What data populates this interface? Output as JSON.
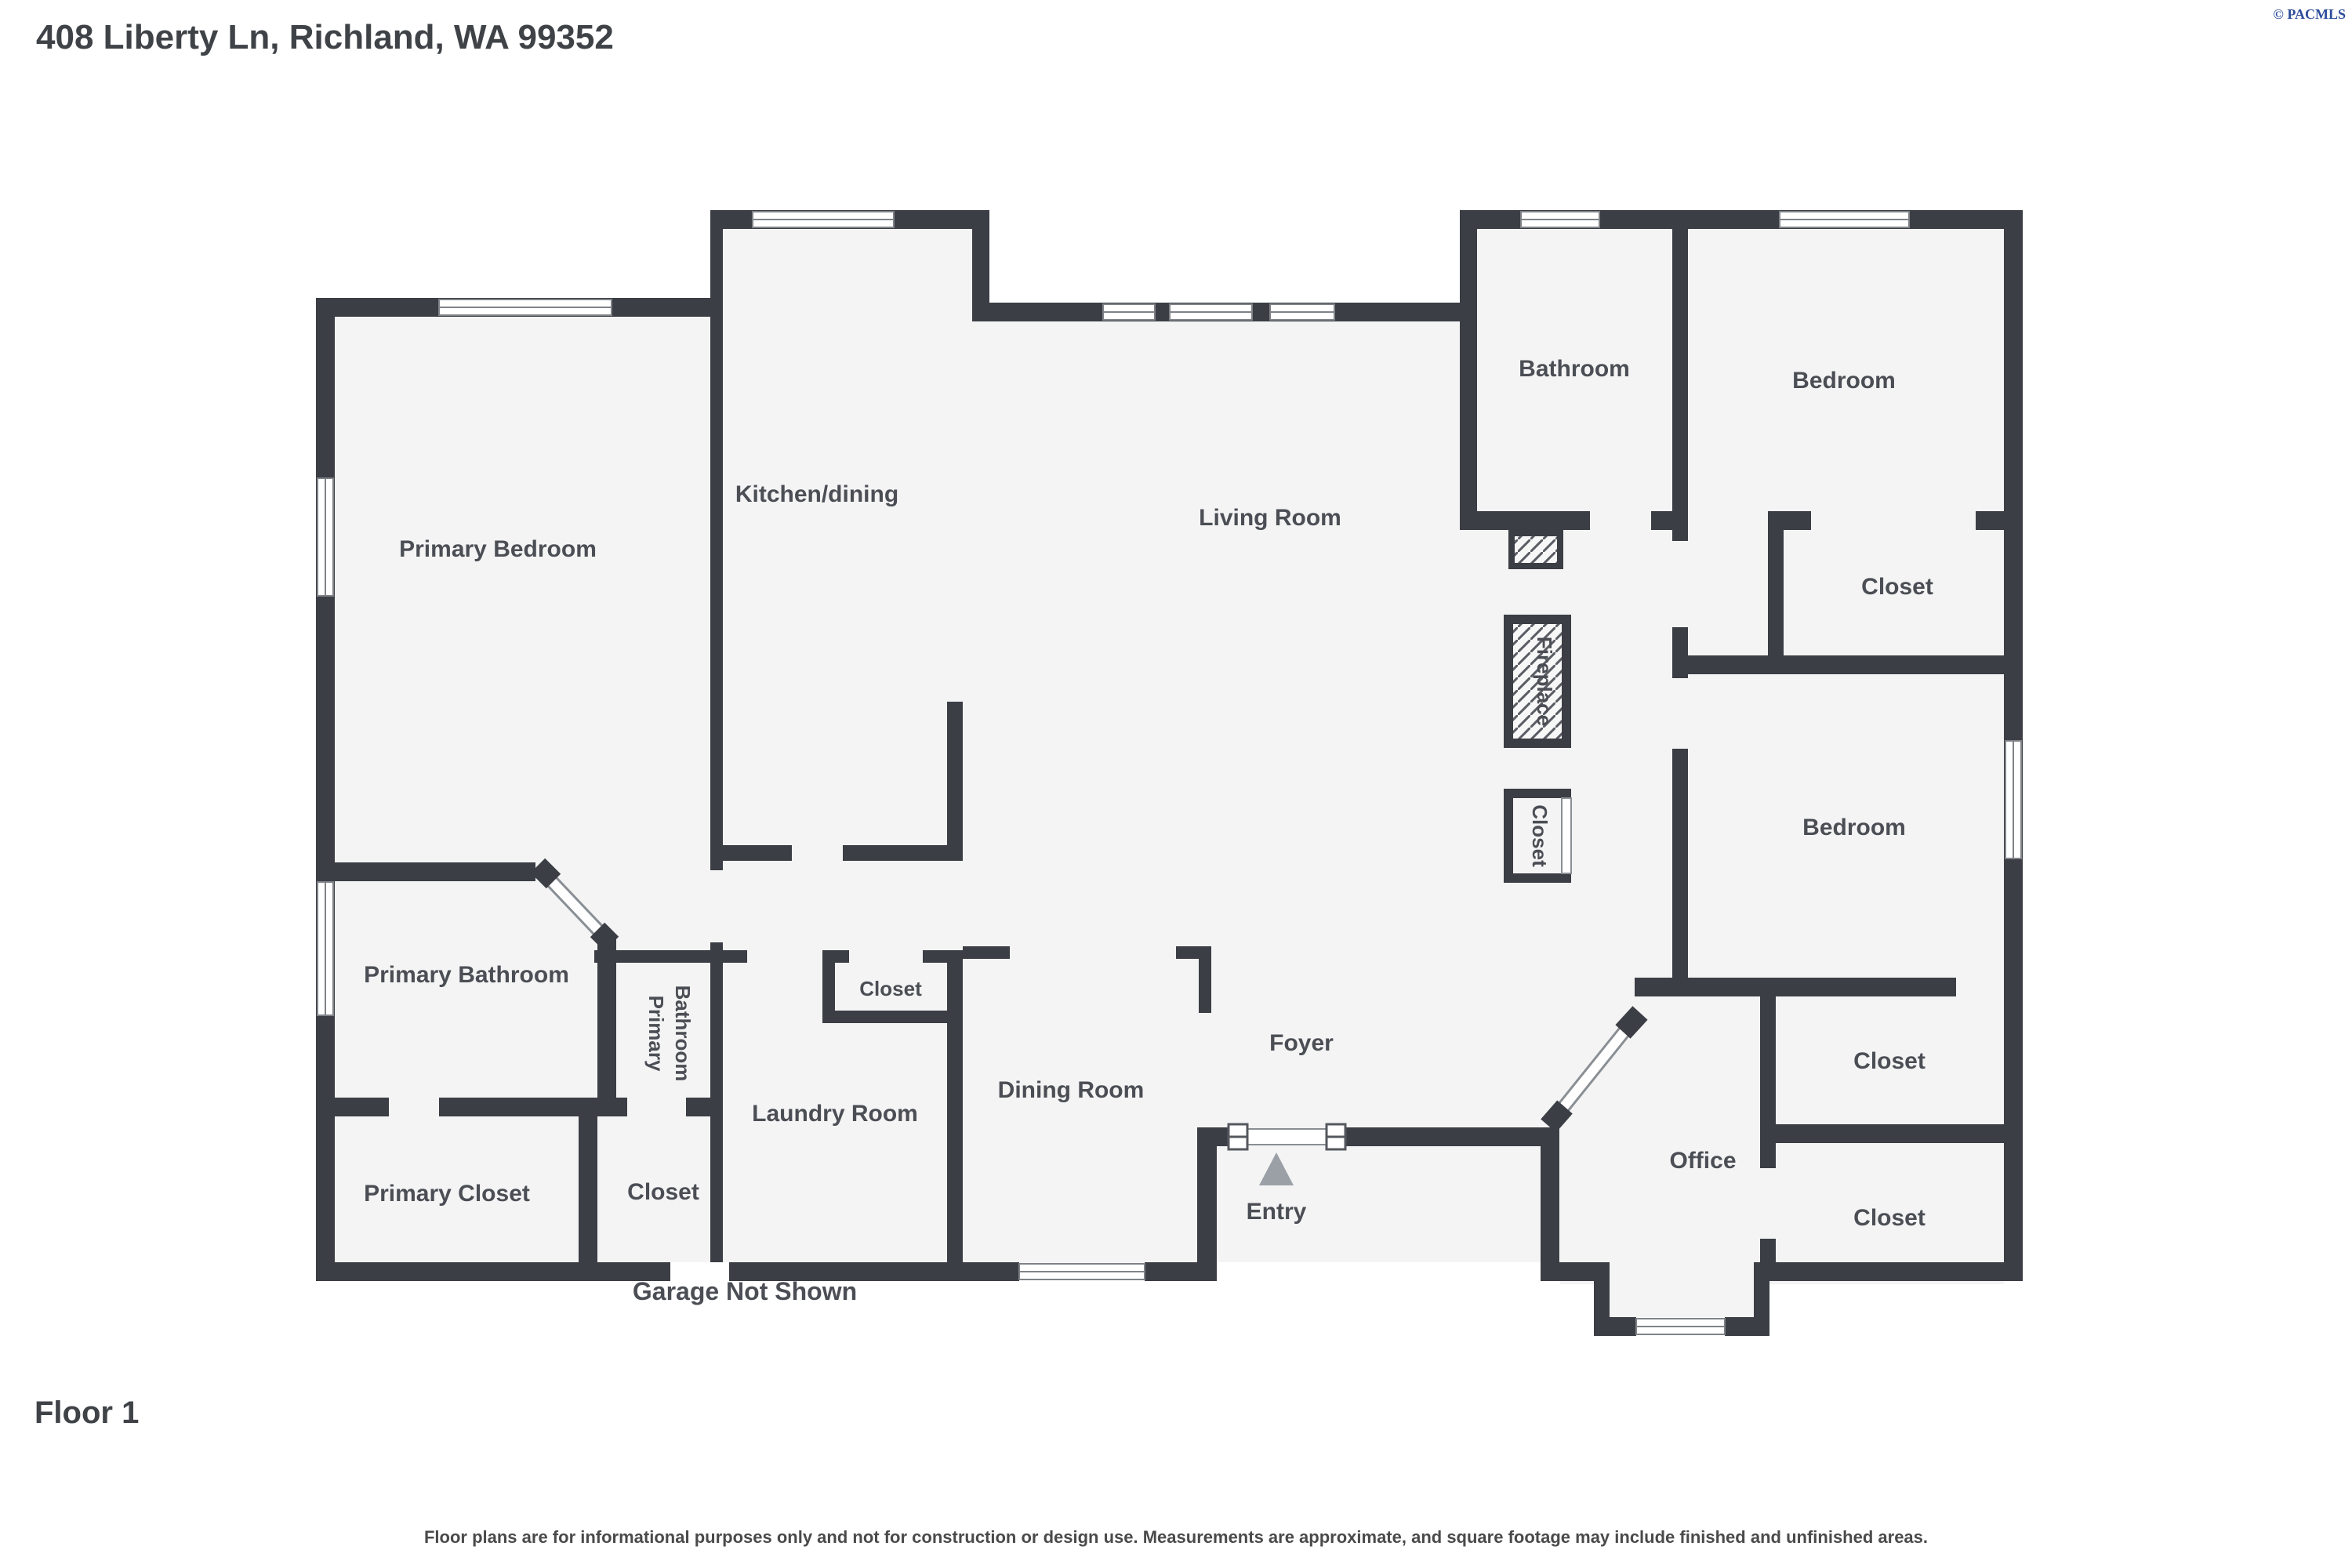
{
  "header": {
    "title": "408 Liberty Ln, Richland, WA 99352",
    "copyright": "© PACMLS"
  },
  "floor": {
    "label": "Floor 1"
  },
  "annotations": {
    "garage_note": "Garage Not Shown",
    "entry_arrow_icon": "triangle-up",
    "disclaimer": "Floor plans are for informational purposes only and not for construction or design use. Measurements are approximate, and square footage may include finished and unfinished areas."
  },
  "colors": {
    "wall": "#3b3e44",
    "room_fill": "#f4f4f5",
    "label": "#4b4e54",
    "copyright_blue": "#2e4d9c",
    "entry_arrow": "#9aa0a6",
    "background": "#ffffff"
  },
  "rooms": [
    {
      "id": "primary-bedroom",
      "label": "Primary Bedroom"
    },
    {
      "id": "kitchen-dining",
      "label": "Kitchen/dining"
    },
    {
      "id": "living-room",
      "label": "Living Room"
    },
    {
      "id": "bathroom",
      "label": "Bathroom"
    },
    {
      "id": "bedroom-ne",
      "label": "Bedroom"
    },
    {
      "id": "closet-ne",
      "label": "Closet"
    },
    {
      "id": "bedroom-e",
      "label": "Bedroom"
    },
    {
      "id": "primary-bathroom",
      "label": "Primary Bathroom"
    },
    {
      "id": "primary-closet",
      "label": "Primary Closet"
    },
    {
      "id": "closet-center",
      "label": "Closet"
    },
    {
      "id": "laundry-room",
      "label": "Laundry Room"
    },
    {
      "id": "closet-kitchen",
      "label": "Closet"
    },
    {
      "id": "dining-room",
      "label": "Dining Room"
    },
    {
      "id": "foyer",
      "label": "Foyer"
    },
    {
      "id": "entry",
      "label": "Entry"
    },
    {
      "id": "office",
      "label": "Office"
    },
    {
      "id": "closet-office-n",
      "label": "Closet"
    },
    {
      "id": "closet-office-s",
      "label": "Closet"
    }
  ],
  "vertical_labels": {
    "hall_line1": "Primary",
    "hall_line2": "Bathroom",
    "fireplace": "Fireplace",
    "closet": "Closet"
  }
}
